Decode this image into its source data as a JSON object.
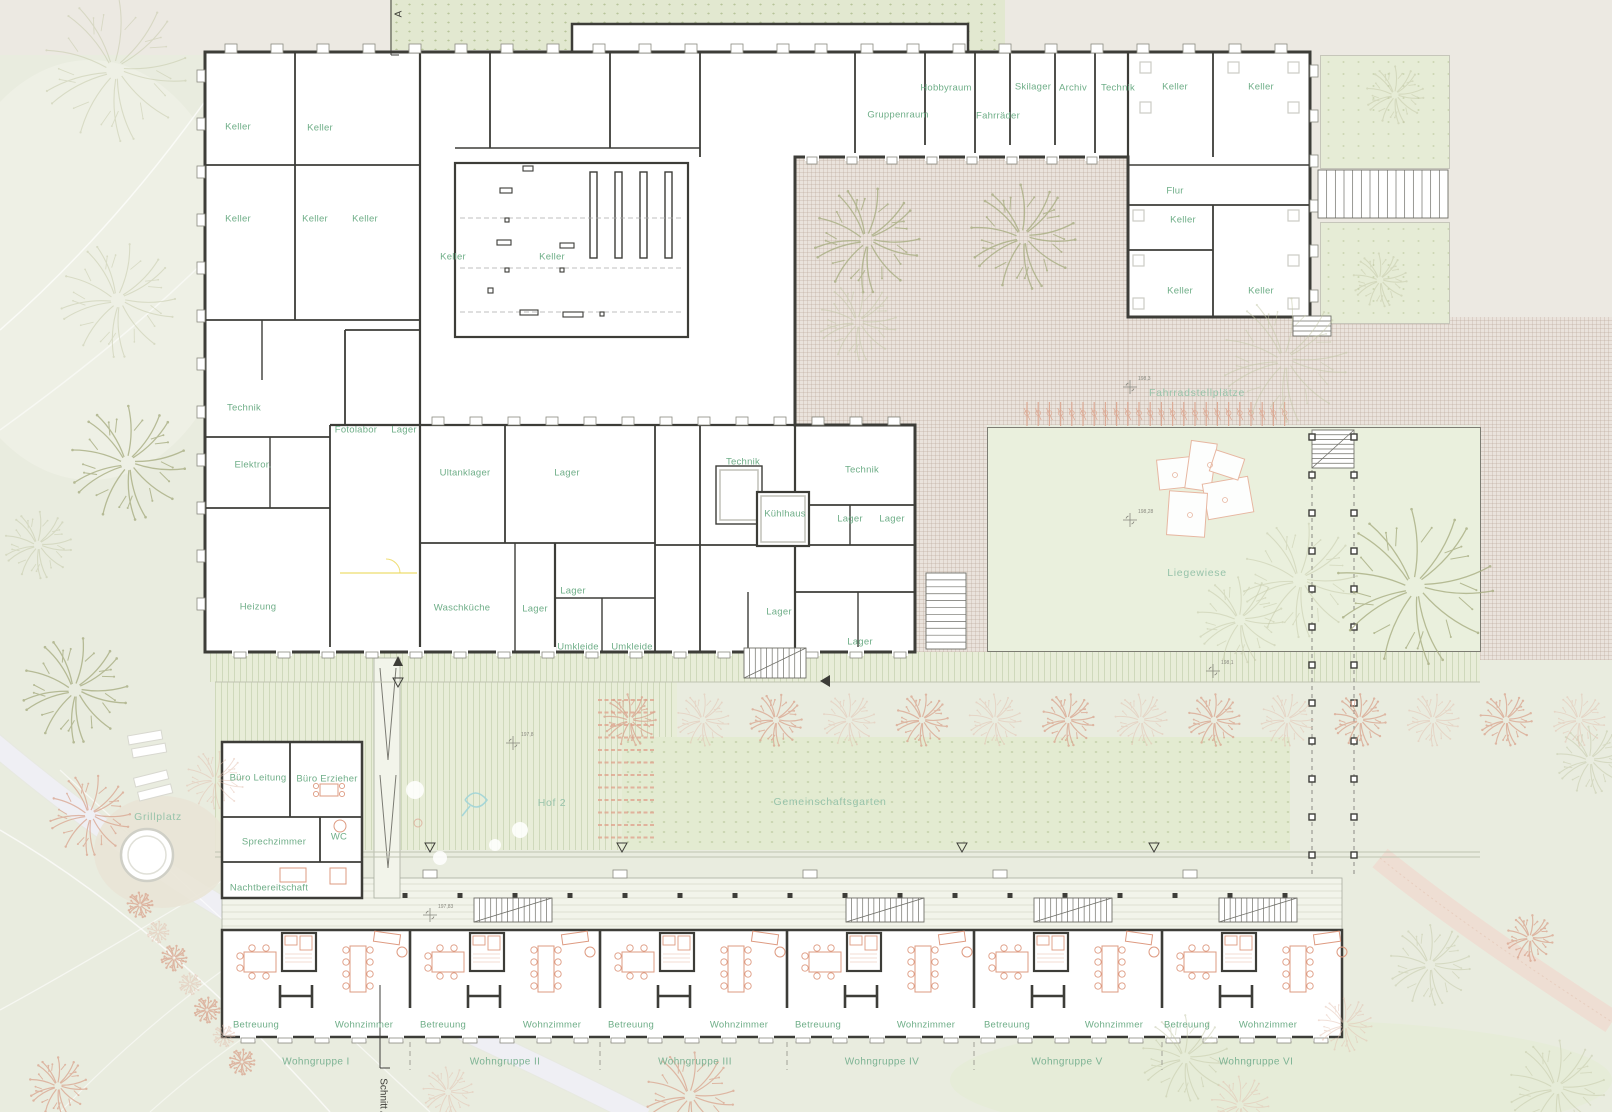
{
  "colors": {
    "background_sage": "#e9ecdf",
    "paper_beige": "#ece9e2",
    "wall_dark": "#3d3d38",
    "room_label_green": "#6fae88",
    "site_label_green": "#97c3aa",
    "courtyard_pink": "#eae3dc",
    "lawn_green": "#eaf0dd",
    "tree_olive": "#b5ba90",
    "tree_pink": "#dcab96",
    "furniture_pink": "#de9b82",
    "path_white": "#f3f5f9",
    "accent_yellow": "#ecd655"
  },
  "section": {
    "top": "A",
    "bottom": "Schnitt A"
  },
  "labels": {
    "rooms": [
      {
        "t": "Keller",
        "x": 238,
        "y": 127
      },
      {
        "t": "Keller",
        "x": 320,
        "y": 128
      },
      {
        "t": "Keller",
        "x": 238,
        "y": 219
      },
      {
        "t": "Keller",
        "x": 315,
        "y": 219
      },
      {
        "t": "Keller",
        "x": 365,
        "y": 219
      },
      {
        "t": "Keller",
        "x": 453,
        "y": 257
      },
      {
        "t": "Keller",
        "x": 552,
        "y": 257
      },
      {
        "t": "Technik",
        "x": 244,
        "y": 408
      },
      {
        "t": "Fotolabor",
        "x": 356,
        "y": 430
      },
      {
        "t": "Lager",
        "x": 404,
        "y": 430
      },
      {
        "t": "Elektror.",
        "x": 253,
        "y": 465
      },
      {
        "t": "Heizung",
        "x": 258,
        "y": 607
      },
      {
        "t": "Ultanklager",
        "x": 465,
        "y": 473
      },
      {
        "t": "Lager",
        "x": 567,
        "y": 473
      },
      {
        "t": "Technik",
        "x": 743,
        "y": 462
      },
      {
        "t": "Technik",
        "x": 862,
        "y": 470
      },
      {
        "t": "Kühlhaus",
        "x": 785,
        "y": 514
      },
      {
        "t": "Lager",
        "x": 850,
        "y": 519
      },
      {
        "t": "Lager",
        "x": 892,
        "y": 519
      },
      {
        "t": "Waschküche",
        "x": 462,
        "y": 608
      },
      {
        "t": "Lager",
        "x": 535,
        "y": 609
      },
      {
        "t": "Lager",
        "x": 573,
        "y": 591
      },
      {
        "t": "Umkleide",
        "x": 578,
        "y": 647
      },
      {
        "t": "Umkleide",
        "x": 632,
        "y": 647
      },
      {
        "t": "Lager",
        "x": 779,
        "y": 612
      },
      {
        "t": "Lager",
        "x": 860,
        "y": 642
      },
      {
        "t": "Gruppenraum",
        "x": 898,
        "y": 115
      },
      {
        "t": "Hobbyraum",
        "x": 946,
        "y": 88
      },
      {
        "t": "Fahrräder",
        "x": 998,
        "y": 116
      },
      {
        "t": "Skilager",
        "x": 1033,
        "y": 87
      },
      {
        "t": "Archiv",
        "x": 1073,
        "y": 88
      },
      {
        "t": "Technik",
        "x": 1118,
        "y": 88
      },
      {
        "t": "Keller",
        "x": 1175,
        "y": 87
      },
      {
        "t": "Keller",
        "x": 1261,
        "y": 87
      },
      {
        "t": "Flur",
        "x": 1175,
        "y": 191
      },
      {
        "t": "Keller",
        "x": 1183,
        "y": 220
      },
      {
        "t": "Keller",
        "x": 1180,
        "y": 291
      },
      {
        "t": "Keller",
        "x": 1261,
        "y": 291
      },
      {
        "t": "Büro Leitung",
        "x": 258,
        "y": 778
      },
      {
        "t": "Büro Erzieher",
        "x": 327,
        "y": 779
      },
      {
        "t": "Sprechzimmer",
        "x": 274,
        "y": 842
      },
      {
        "t": "WC",
        "x": 339,
        "y": 837
      },
      {
        "t": "Nachtbereitschaft",
        "x": 269,
        "y": 888
      },
      {
        "t": "Betreuung",
        "x": 256,
        "y": 1025
      },
      {
        "t": "Wohnzimmer",
        "x": 364,
        "y": 1025
      },
      {
        "t": "Betreuung",
        "x": 443,
        "y": 1025
      },
      {
        "t": "Wohnzimmer",
        "x": 552,
        "y": 1025
      },
      {
        "t": "Betreuung",
        "x": 631,
        "y": 1025
      },
      {
        "t": "Wohnzimmer",
        "x": 739,
        "y": 1025
      },
      {
        "t": "Betreuung",
        "x": 818,
        "y": 1025
      },
      {
        "t": "Wohnzimmer",
        "x": 926,
        "y": 1025
      },
      {
        "t": "Betreuung",
        "x": 1007,
        "y": 1025
      },
      {
        "t": "Wohnzimmer",
        "x": 1114,
        "y": 1025
      },
      {
        "t": "Betreuung",
        "x": 1187,
        "y": 1025
      },
      {
        "t": "Wohnzimmer",
        "x": 1268,
        "y": 1025
      }
    ],
    "site": [
      {
        "t": "Fahrradstellplätze",
        "x": 1197,
        "y": 393
      },
      {
        "t": "Liegewiese",
        "x": 1197,
        "y": 573
      },
      {
        "t": "Hof 2",
        "x": 552,
        "y": 803
      },
      {
        "t": "Gemeinschaftsgarten",
        "x": 830,
        "y": 802
      },
      {
        "t": "Grillplatz",
        "x": 158,
        "y": 817
      }
    ],
    "groups": [
      {
        "t": "Wohngruppe I",
        "x": 316,
        "y": 1062
      },
      {
        "t": "Wohngruppe II",
        "x": 505,
        "y": 1062
      },
      {
        "t": "Wohngruppe III",
        "x": 695,
        "y": 1062
      },
      {
        "t": "Wohngruppe IV",
        "x": 882,
        "y": 1062
      },
      {
        "t": "Wohngruppe V",
        "x": 1067,
        "y": 1062
      },
      {
        "t": "Wohngruppe VI",
        "x": 1256,
        "y": 1062
      }
    ],
    "survey": [
      {
        "t": "198,3",
        "x": 1138,
        "y": 379
      },
      {
        "t": "198,28",
        "x": 1138,
        "y": 512
      },
      {
        "t": "197,8",
        "x": 521,
        "y": 735
      },
      {
        "t": "197,83",
        "x": 438,
        "y": 907
      },
      {
        "t": "198,1",
        "x": 1221,
        "y": 663
      }
    ]
  }
}
